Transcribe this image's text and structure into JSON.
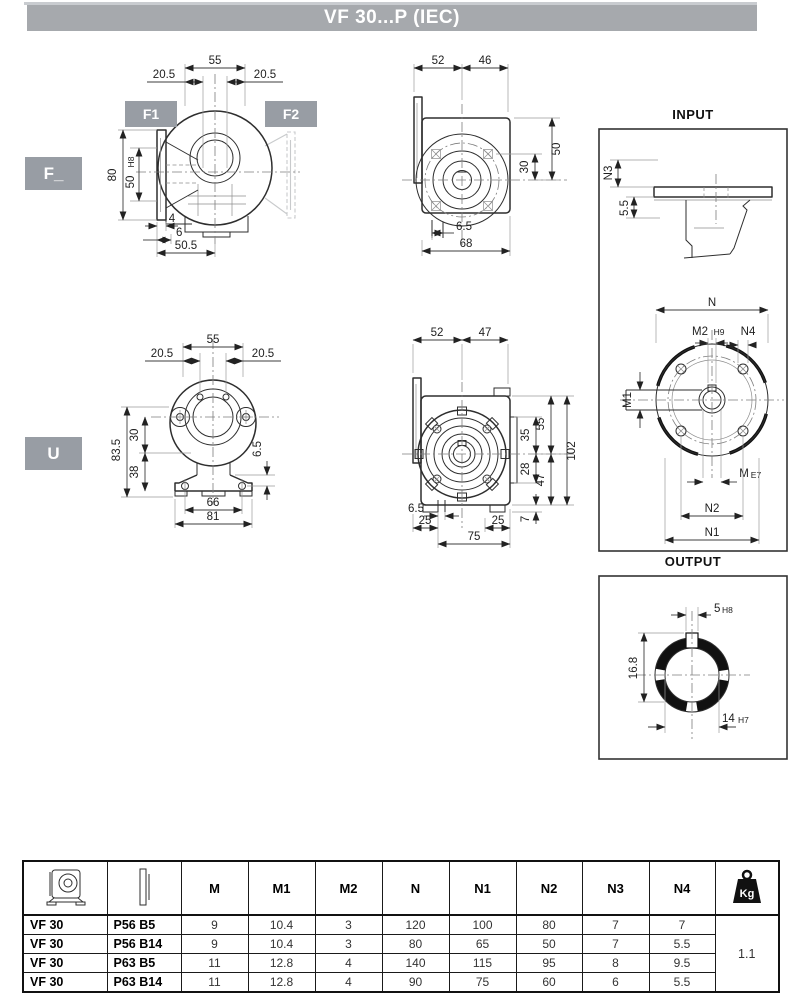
{
  "title": "VF 30...P (IEC)",
  "variant_labels": {
    "f": "F_",
    "u": "U",
    "f1": "F1",
    "f2": "F2"
  },
  "panels": {
    "input": "INPUT",
    "output": "OUTPUT"
  },
  "colors": {
    "header_bar": "#a6a9ad",
    "label_box": "#989da4"
  },
  "dims": {
    "f_front": {
      "w55": "55",
      "l205": "20.5",
      "r205": "20.5",
      "h80": "80",
      "bore": "50",
      "bore_tol": "H8",
      "t4": "4",
      "t6": "6",
      "w505": "50.5"
    },
    "f_side": {
      "a52": "52",
      "b46": "46",
      "h50": "50",
      "h30": "30",
      "s65": "6.5",
      "w68": "68"
    },
    "input": {
      "n3": "N3",
      "s55": "5.5",
      "n": "N",
      "m2": "M2",
      "m2_tol": "H9",
      "n4": "N4",
      "m1": "M1",
      "m": "M",
      "m_tol": "E7",
      "n2": "N2",
      "n1": "N1"
    },
    "u_front": {
      "w55": "55",
      "l205": "20.5",
      "r205": "20.5",
      "h835": "83.5",
      "h30": "30",
      "h38": "38",
      "s65": "6.5",
      "w66": "66",
      "w81": "81"
    },
    "u_side": {
      "a52": "52",
      "b47": "47",
      "h55": "55",
      "h35": "35",
      "h28": "28",
      "h47": "47",
      "h102": "102",
      "s65": "6.5",
      "l25": "25",
      "r25": "25",
      "w75": "75",
      "t7": "7"
    },
    "output": {
      "key": "5",
      "key_tol": "H8",
      "depth": "16.8",
      "bore": "14",
      "bore_tol": "H7"
    }
  },
  "table": {
    "headers": [
      "M",
      "M1",
      "M2",
      "N",
      "N1",
      "N2",
      "N3",
      "N4"
    ],
    "kg": "Kg",
    "rows": [
      {
        "model": "VF 30",
        "mount": "P56 B5",
        "values": [
          "9",
          "10.4",
          "3",
          "120",
          "100",
          "80",
          "7",
          "7"
        ]
      },
      {
        "model": "VF 30",
        "mount": "P56 B14",
        "values": [
          "9",
          "10.4",
          "3",
          "80",
          "65",
          "50",
          "7",
          "5.5"
        ]
      },
      {
        "model": "VF 30",
        "mount": "P63 B5",
        "values": [
          "11",
          "12.8",
          "4",
          "140",
          "115",
          "95",
          "8",
          "9.5"
        ]
      },
      {
        "model": "VF 30",
        "mount": "P63 B14",
        "values": [
          "11",
          "12.8",
          "4",
          "90",
          "75",
          "60",
          "6",
          "5.5"
        ]
      }
    ],
    "weight_kg": "1.1"
  }
}
